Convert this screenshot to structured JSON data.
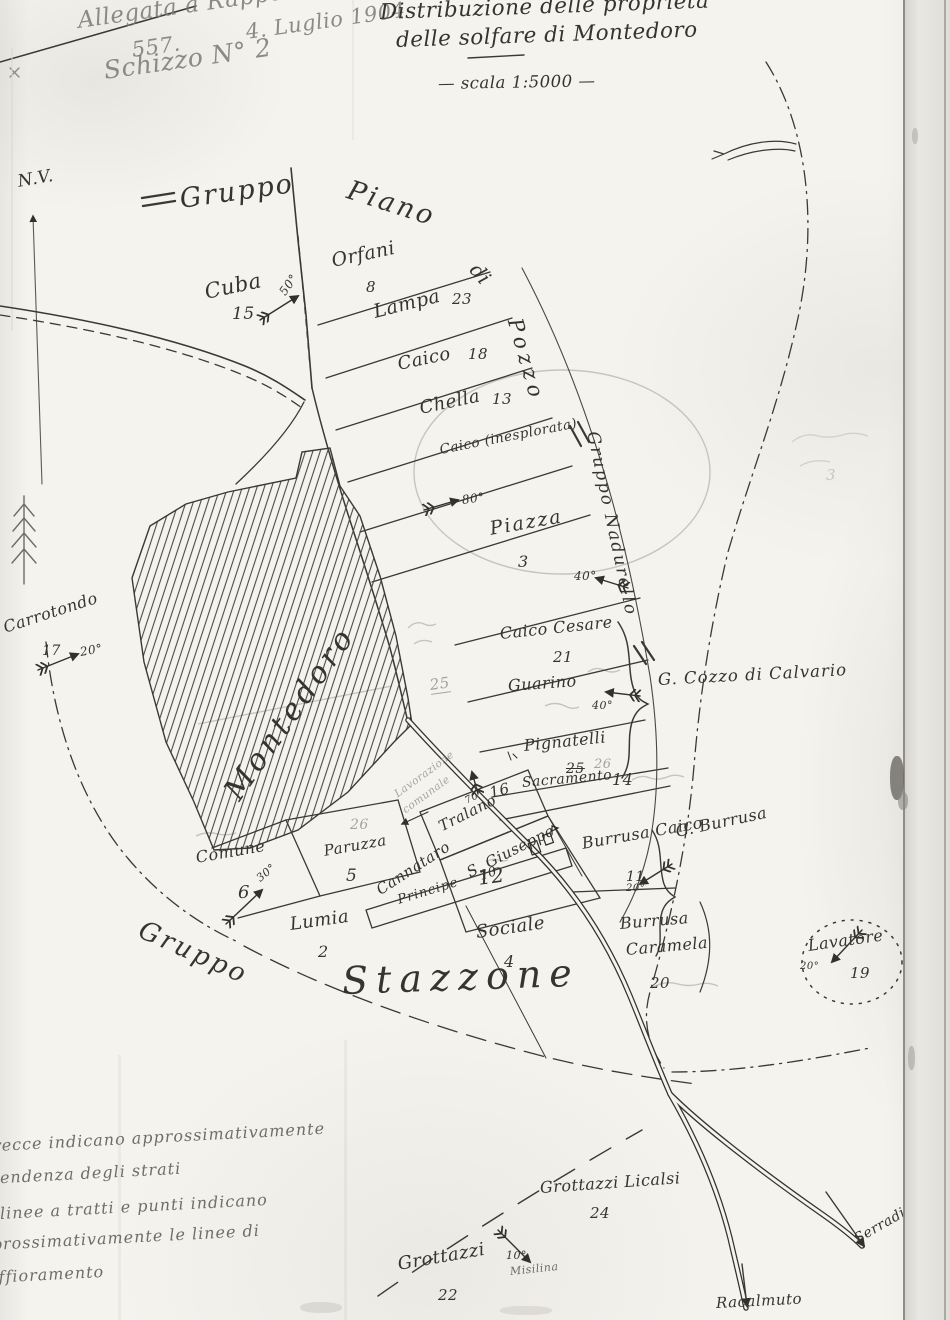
{
  "header": {
    "attach_line1": "Allegata a Rapporto",
    "attach_num": "557.",
    "attach_date": "4. Luglio 1904",
    "attach_line2": "Schizzo N° 2",
    "title_line1": "Distribuzione delle proprieta",
    "title_line2": "delle solfare di Montedoro",
    "scale": "— scala 1:5000 —",
    "north": "N.V."
  },
  "groups": {
    "piano_a": "Gruppo",
    "piano_b": "Piano",
    "piano_c": "di",
    "piano_d": "Pozzo",
    "nadurello": "Gruppo Nadurello",
    "stazzone_a": "Gruppo",
    "stazzone_b": "Stazzone"
  },
  "parcels": {
    "cuba": {
      "name": "Cuba",
      "num": "15",
      "dip": "50°"
    },
    "orfani": {
      "name": "Orfani",
      "num": "8"
    },
    "lampa": {
      "name": "Lampa",
      "num": "23"
    },
    "caico": {
      "name": "Caico",
      "num": "18"
    },
    "chella": {
      "name": "Chella",
      "num": "13"
    },
    "caico2": {
      "name": "Caico (inesplorata)",
      "dip": "80°"
    },
    "piazza": {
      "name": "Piazza",
      "num": "3",
      "dip": "40°"
    },
    "caico_cesare": {
      "name": "Caico Cesare",
      "num": "21"
    },
    "guarino": {
      "name": "Guarino",
      "dip": "40°"
    },
    "pignatelli": {
      "name": "Pignatelli",
      "num_struck": "25",
      "num_pencil": "26"
    },
    "sacramento": {
      "name": "Sacramento",
      "num": "14"
    },
    "burrusa_caico": {
      "name": "Burrusa Caico",
      "num": "11",
      "dip": "20°"
    },
    "burrusa_caramela": {
      "name_a": "Burrusa",
      "name_b": "Caramela",
      "num": "20"
    },
    "lavatore": {
      "name": "Lavatore",
      "num": "19",
      "dip": "20°"
    },
    "carrotondo": {
      "name": "Carrotondo",
      "num": "17",
      "dip": "20°"
    },
    "comune": {
      "name": "Comune",
      "num": "6",
      "dip": "30°"
    },
    "paruzza": {
      "name": "Paruzza",
      "num": "5"
    },
    "cannataro": {
      "name": "Cannataro",
      "num": "12"
    },
    "tralano": {
      "name": "Tralano",
      "num": "16",
      "dip": "70°"
    },
    "s_giuseppe": {
      "name": "S. Giuseppe"
    },
    "principe": {
      "name": "Principe",
      "num": "10"
    },
    "lumia": {
      "name": "Lumia",
      "num": "2"
    },
    "sociale": {
      "name": "Sociale",
      "num": "4"
    },
    "grottazzi_licalsi": {
      "name": "Grottazzi Licalsi",
      "num": "24"
    },
    "grottazzi": {
      "name": "Grottazzi",
      "num": "22",
      "dip": "10°",
      "note": "Misilina"
    }
  },
  "places": {
    "montedoro": "Montedoro",
    "cozzo": "G. Cozzo di Calvario",
    "g_burrusa": "G. Burrusa",
    "serradife": "Serradife",
    "racalmuto": "Racalmuto"
  },
  "pencil": {
    "n25": "25",
    "n26": "26",
    "note_a": "Lavorazione",
    "note_b": "comunale",
    "n3": "3"
  },
  "legend": {
    "l1": "Le frecce indicano approssimativamente",
    "l2": "la pendenza degli strati",
    "l3": "linee a tratti e punti indicano",
    "l4": "approssimativamente le linee di",
    "l5": "affioramento"
  }
}
